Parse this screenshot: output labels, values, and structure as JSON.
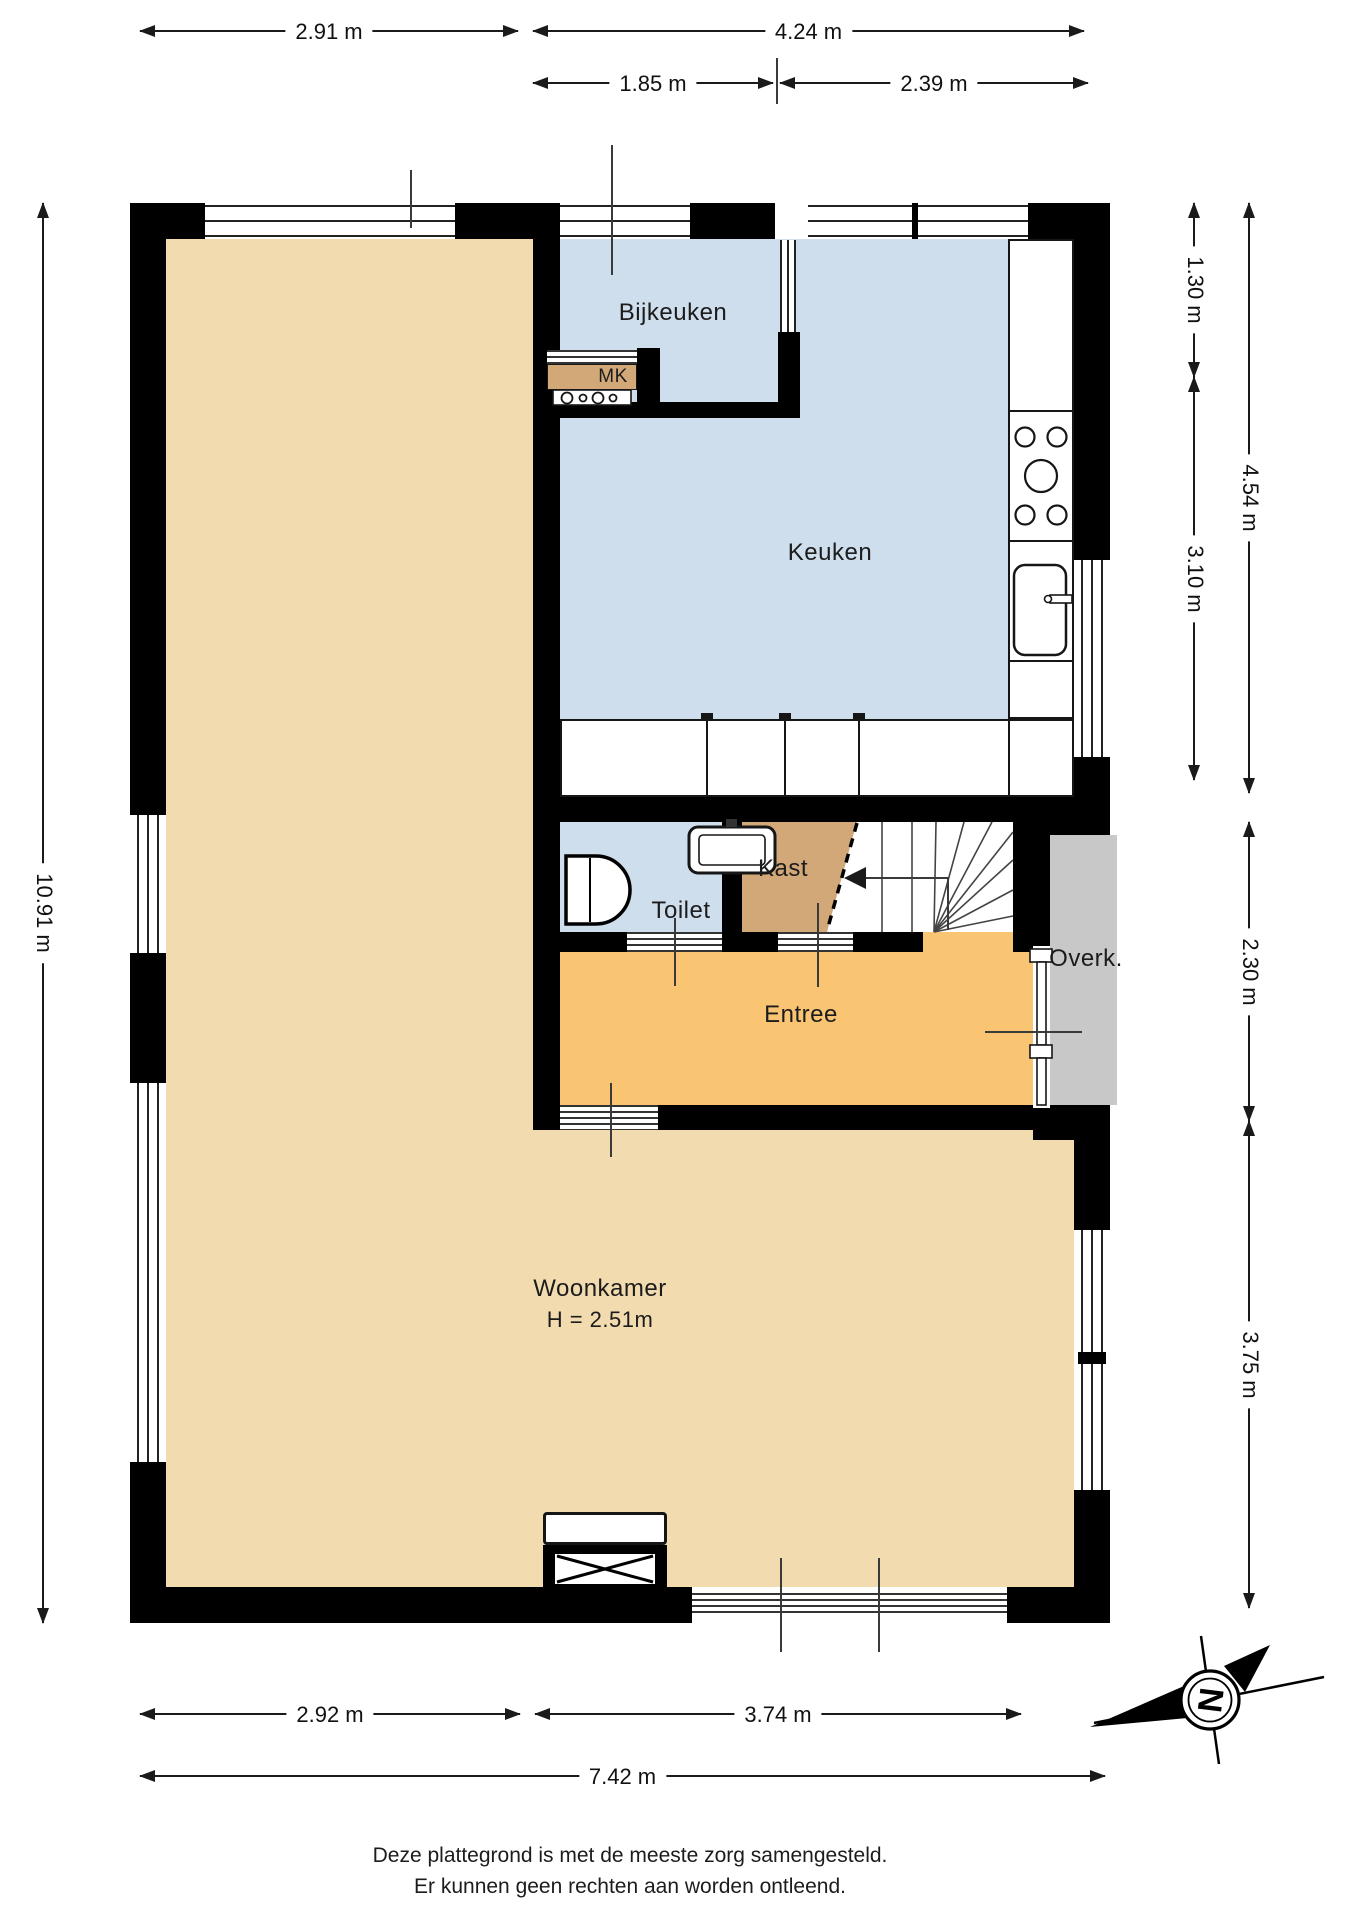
{
  "rooms": {
    "bijkeuken": {
      "label": "Bijkeuken"
    },
    "mk": {
      "label": "MK"
    },
    "keuken": {
      "label": "Keuken"
    },
    "toilet": {
      "label": "Toilet"
    },
    "kast": {
      "label": "Kast"
    },
    "entree": {
      "label": "Entree"
    },
    "overkapping": {
      "label": "Overk."
    },
    "woonkamer": {
      "label": "Woonkamer",
      "ceiling_height": "H = 2.51m"
    }
  },
  "dimensions": {
    "top": [
      {
        "label": "2.91 m"
      },
      {
        "label": "4.24 m"
      },
      {
        "label": "1.85 m"
      },
      {
        "label": "2.39 m"
      }
    ],
    "left": [
      {
        "label": "10.91 m"
      }
    ],
    "right": [
      {
        "label": "1.30 m"
      },
      {
        "label": "4.54 m"
      },
      {
        "label": "3.10 m"
      },
      {
        "label": "2.30 m"
      },
      {
        "label": "3.75 m"
      }
    ],
    "bottom": [
      {
        "label": "2.92 m"
      },
      {
        "label": "3.74 m"
      },
      {
        "label": "7.42 m"
      }
    ]
  },
  "compass": {
    "north": "N"
  },
  "footer": {
    "line1": "Deze plattegrond is met de meeste zorg samengesteld.",
    "line2": "Er kunnen geen rechten aan worden ontleend."
  },
  "colors": {
    "wall": "#000000",
    "floor-living": "#f2dbae",
    "floor-kitchen": "#cfdeed",
    "floor-entry": "#f9c573",
    "floor-closet": "#d3a878",
    "floor-overhang": "#c8c8c8"
  }
}
